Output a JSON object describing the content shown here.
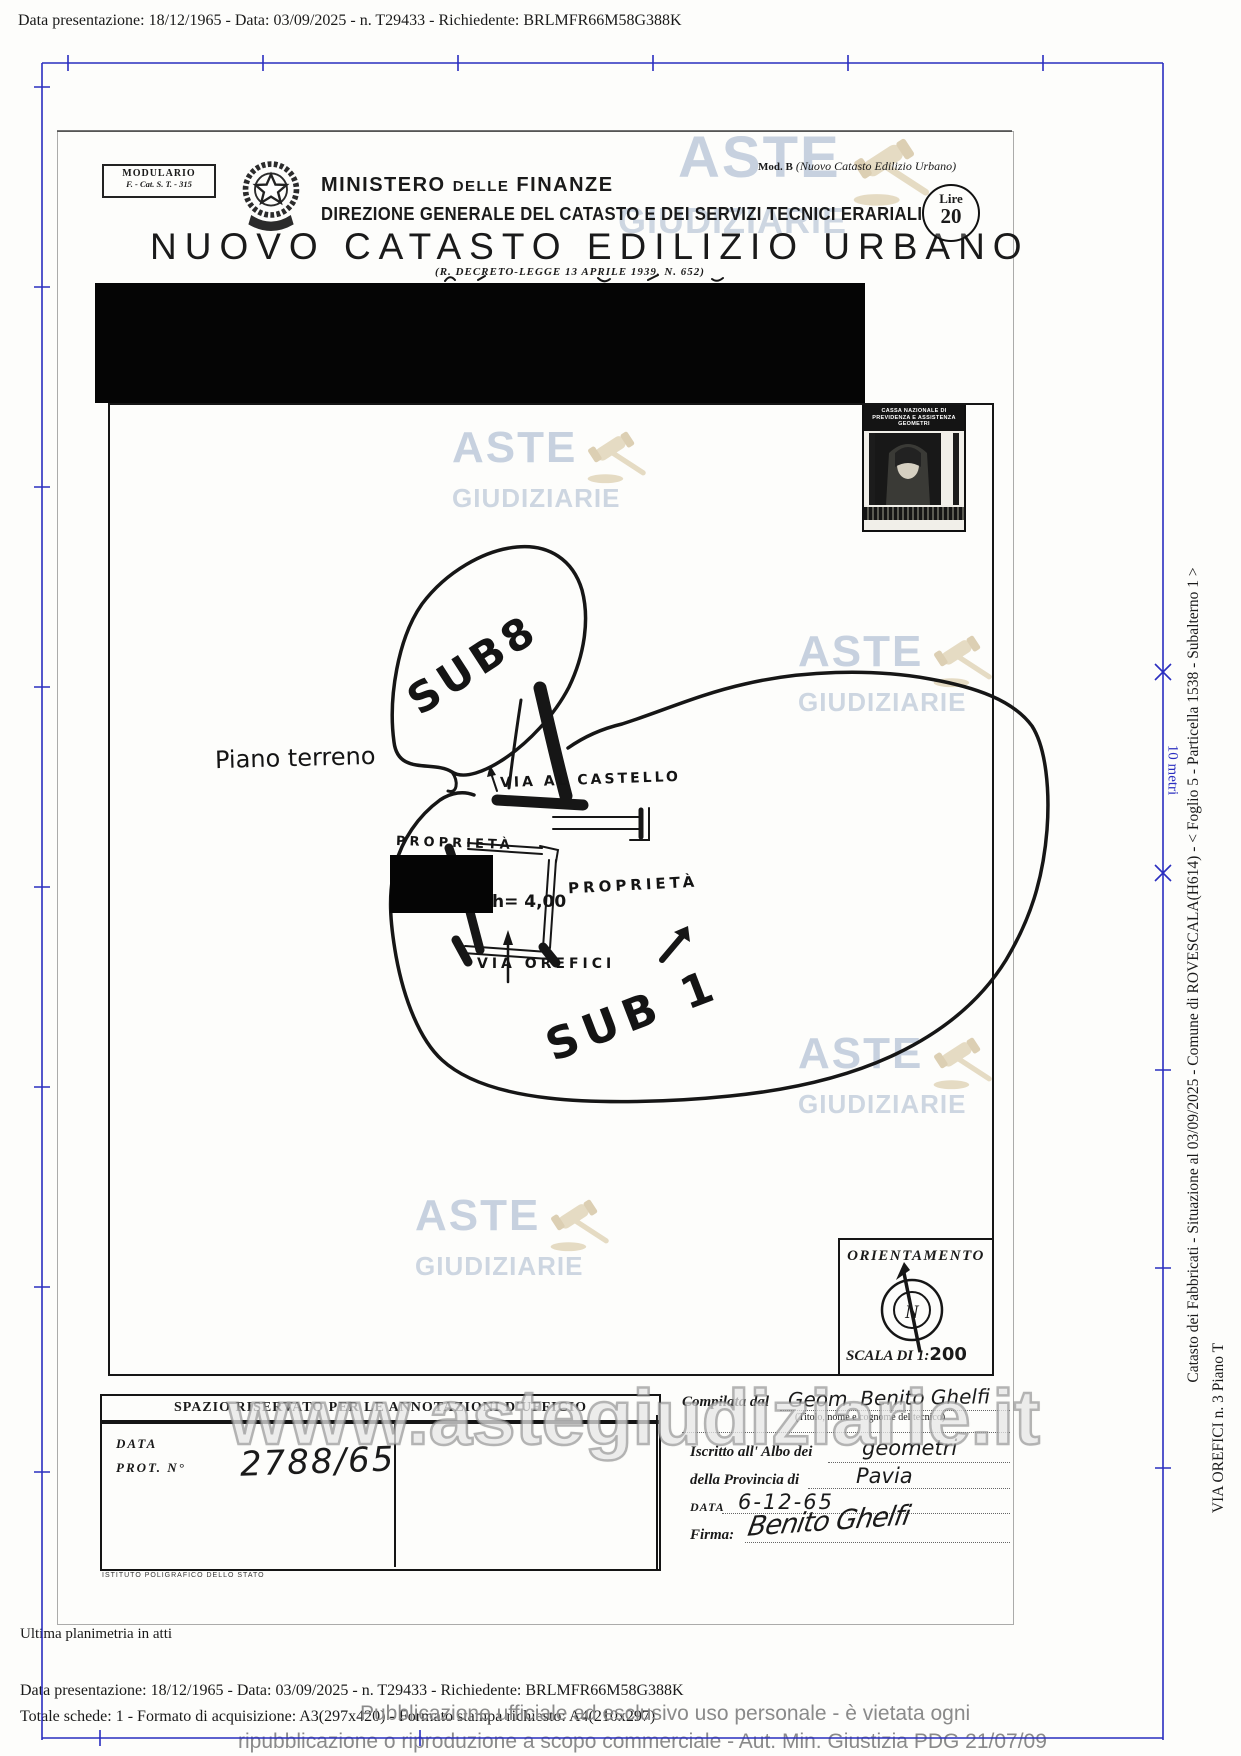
{
  "meta_line": "Data presentazione: 18/12/1965 - Data: 03/09/2025 - n. T29433 - Richiedente: BRLMFR66M58G388K",
  "header": {
    "modulario_line1": "MODULARIO",
    "modulario_line2": "F. - Cat. S. T. - 315",
    "ministry_word1": "MINISTERO",
    "ministry_word2": "DELLE",
    "ministry_word3": "FINANZE",
    "ministry_line2": "DIREZIONE GENERALE DEL CATASTO E DEI SERVIZI TECNICI ERARIALI",
    "title": "NUOVO CATASTO EDILIZIO URBANO",
    "subtitle": "(R. DECRETO-LEGGE 13 APRILE 1939, N. 652)",
    "mod_b_label": "Mod. B",
    "mod_b_text": "(Nuovo Catasto Edilizio Urbano)",
    "lire_label": "Lire",
    "lire_value": "20"
  },
  "revenue_stamp": {
    "line1": "CASSA NAZIONALE DI",
    "line2": "PREVIDENZA E ASSISTENZA",
    "line3": "GEOMETRI"
  },
  "map": {
    "floor_label": "Piano terreno",
    "sub8_label": "SUB8",
    "sub1_label": "SUB 1",
    "street_top": "VIA AL CASTELLO",
    "street_bottom": "VIA OREFICI",
    "property_left": "PROPRIETÀ",
    "property_right": "PROPRIETÀ",
    "height_label": "h= 4,00",
    "orientation_label": "ORIENTAMENTO",
    "compass_n": "N",
    "scale_prefix": "SCALA DI 1:",
    "scale_value": "200"
  },
  "annotations_box": {
    "title": "SPAZIO RISERVATO PER LE ANNOTAZIONI D'UFFICIO",
    "date_label": "DATA",
    "protocol_label": "PROT. N°",
    "protocol_value": "2788/65",
    "printer_note": "ISTITUTO POLIGRAFICO DELLO STATO"
  },
  "technician_form": {
    "compiled_by_label": "Compilata dal",
    "compiled_by_value": "Geom. Benito Ghelfi",
    "compiled_by_note": "(Titolo, nome e cognome del tecnico)",
    "register_label": "Iscritto all' Albo dei",
    "register_value": "geometri",
    "province_label": "della Provincia di",
    "province_value": "Pavia",
    "date_label": "DATA",
    "date_value": "6-12-65",
    "signature_label": "Firma:",
    "signature_value": "Benito Ghelfi"
  },
  "sidebar": {
    "info_line": "Catasto dei Fabbricati - Situazione al 03/09/2025 - Comune di ROVESCALA(H614) - < Foglio 5 - Particella 1538 - Subalterno 1 >",
    "address_line": "VIA OREFICI n. 3 Piano T",
    "measure_label": "10 metri"
  },
  "watermark": {
    "aste": "ASTE",
    "giudiziarie": "GIUDIZIARIE",
    "url": "www.astegiudiziarie.it",
    "disclaimer_line1": "Pubblicazione ufficiale ad esclusivo uso personale - è vietata ogni",
    "disclaimer_line2": "ripubblicazione o riproduzione a scopo commerciale - Aut. Min. Giustizia PDG 21/07/09"
  },
  "footer": {
    "last_plan_note": "Ultima planimetria in atti",
    "meta_line2": "Totale schede: 1 - Formato di acquisizione: A3(297x420) - Formato stampa richiesto: A4(210x297)"
  },
  "colors": {
    "frame_blue": "#2a2ec0",
    "watermark_blue": "#a9b9cf",
    "gavel_tan": "#d9c9a6",
    "disclaimer_gray": "#8a8a8a"
  }
}
